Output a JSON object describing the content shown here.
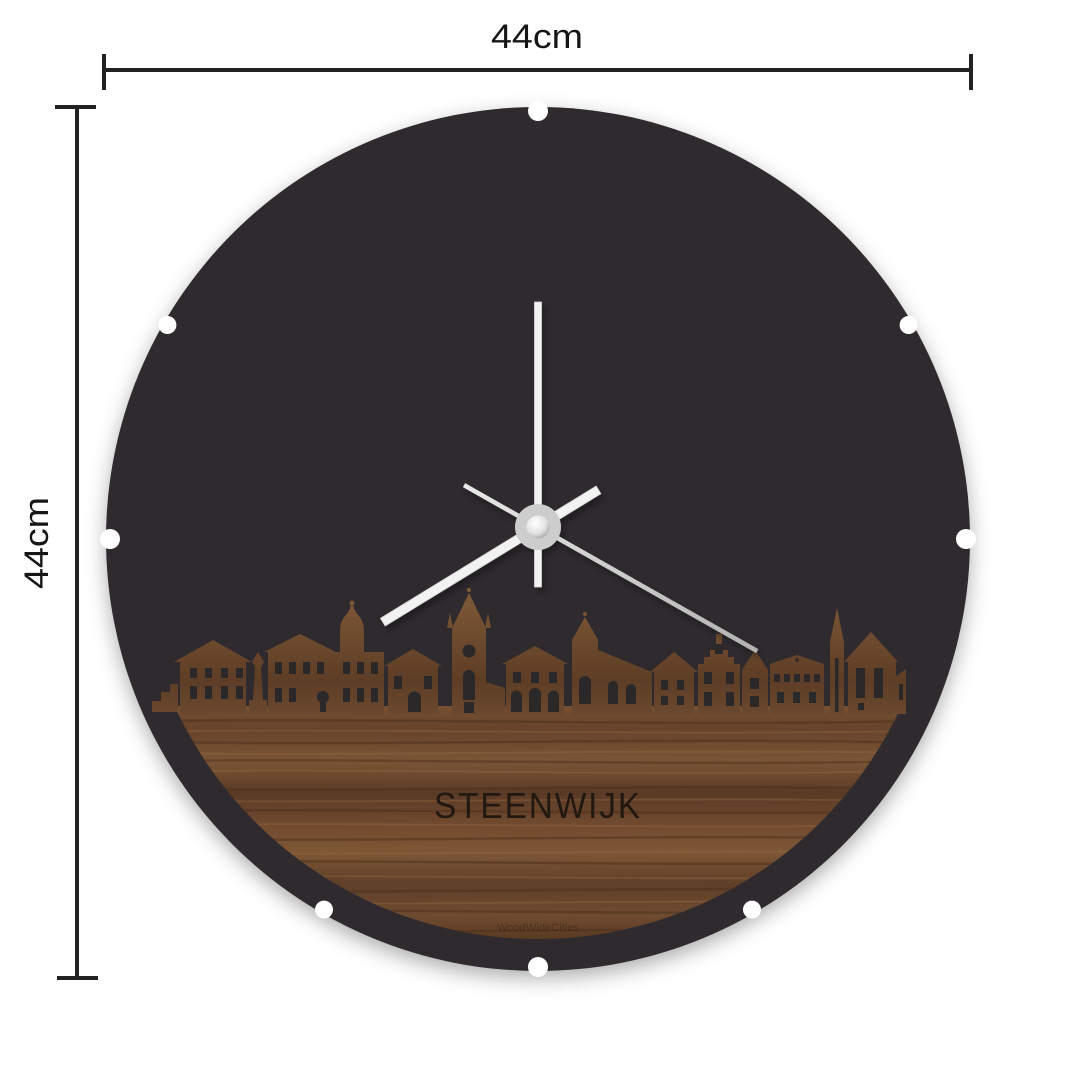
{
  "product": {
    "city_label": "STEENWIJK",
    "brand_watermark": "WoodWideCities"
  },
  "dimensions": {
    "width_label": "44cm",
    "height_label": "44cm"
  },
  "clock": {
    "minute_angle_deg": 0,
    "hour_angle_deg": 238.5,
    "second_angle_deg": 119.5,
    "notch_angles_deg": [
      0,
      60,
      90,
      150,
      180,
      210,
      270,
      300
    ]
  },
  "colors": {
    "background": "#ffffff",
    "disc": "#2e2c2d",
    "window_cutout": "#2a2829",
    "wood_mid": "#6b4930",
    "wood_dark": "#452b1b",
    "wood_light": "#9a6f45",
    "hand_white": "#f2f2f2",
    "second_hand_silver": "#c2c2c2",
    "hub_gray": "#cdcdcd",
    "dimension_line": "#222222"
  }
}
